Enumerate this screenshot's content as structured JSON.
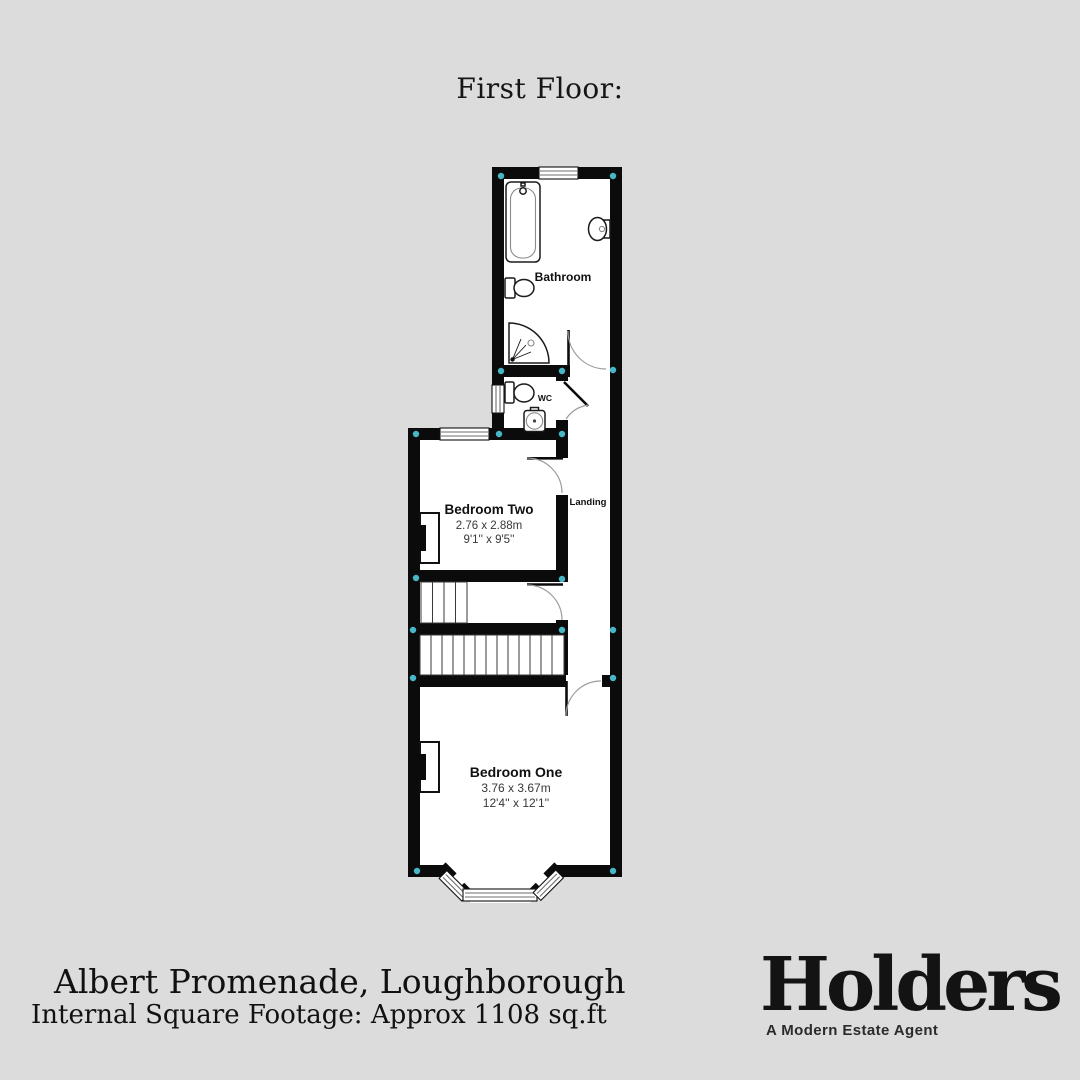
{
  "page": {
    "title": "First Floor:"
  },
  "colors": {
    "background": "#dcdcdc",
    "wall": "#0b0b0b",
    "corner_dot": "#47b7c6"
  },
  "floorplan": {
    "rooms": {
      "bathroom": {
        "label": "Bathroom"
      },
      "wc": {
        "label": "WC"
      },
      "landing": {
        "label": "Landing"
      },
      "bedroom_two": {
        "label": "Bedroom Two",
        "metric": "2.76 x 2.88m",
        "imperial": "9'1'' x 9'5''"
      },
      "bedroom_one": {
        "label": "Bedroom One",
        "metric": "3.76 x 3.67m",
        "imperial": "12'4'' x 12'1''"
      }
    }
  },
  "footer": {
    "address": "Albert Promenade, Loughborough",
    "square_footage": "Internal Square Footage: Approx 1108 sq.ft"
  },
  "brand": {
    "logo_text": "Holders",
    "tagline": "A Modern Estate Agent"
  }
}
